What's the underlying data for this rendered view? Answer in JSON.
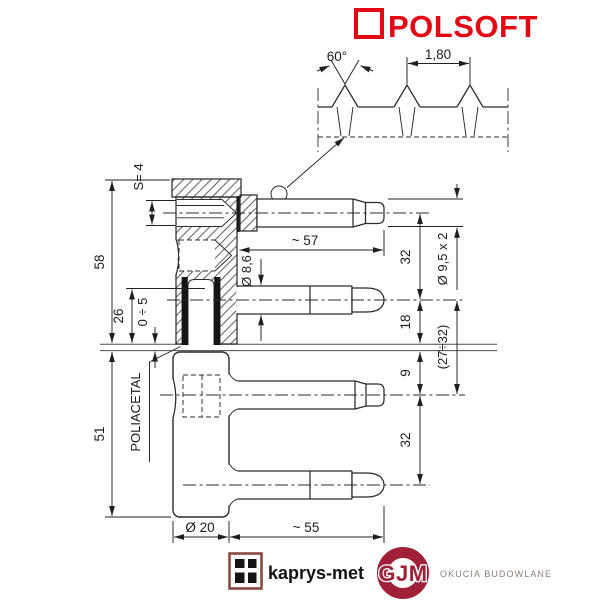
{
  "brand": {
    "name": "POLSOFT",
    "color": "#e30613"
  },
  "thread_detail": {
    "angle": "60°",
    "pitch": "1,80"
  },
  "dims": {
    "s": "S= 4",
    "upper_height": "58",
    "socket_depth": "26",
    "gap": "0 ÷ 5",
    "pin1_length": "~ 57",
    "pin2_diameter": "Ø 8,6",
    "pin_pitch_top": "32",
    "split_top": "18",
    "pin_diameter": "Ø 9,5 x 2",
    "range": "(27÷32)",
    "split_bottom": "9",
    "pin_pitch_bottom": "32",
    "lower_height": "51",
    "material": "POLIACETAL",
    "body_diameter": "Ø 20",
    "pin4_length": "~ 55"
  },
  "footer": {
    "kaprys": "kaprys-met",
    "gjm": "GJM",
    "gjm_sub": "OKUCIA BUDOWLANE",
    "gjm_color": "#a02038",
    "kaprys_frame_color": "#8a4a3f"
  }
}
